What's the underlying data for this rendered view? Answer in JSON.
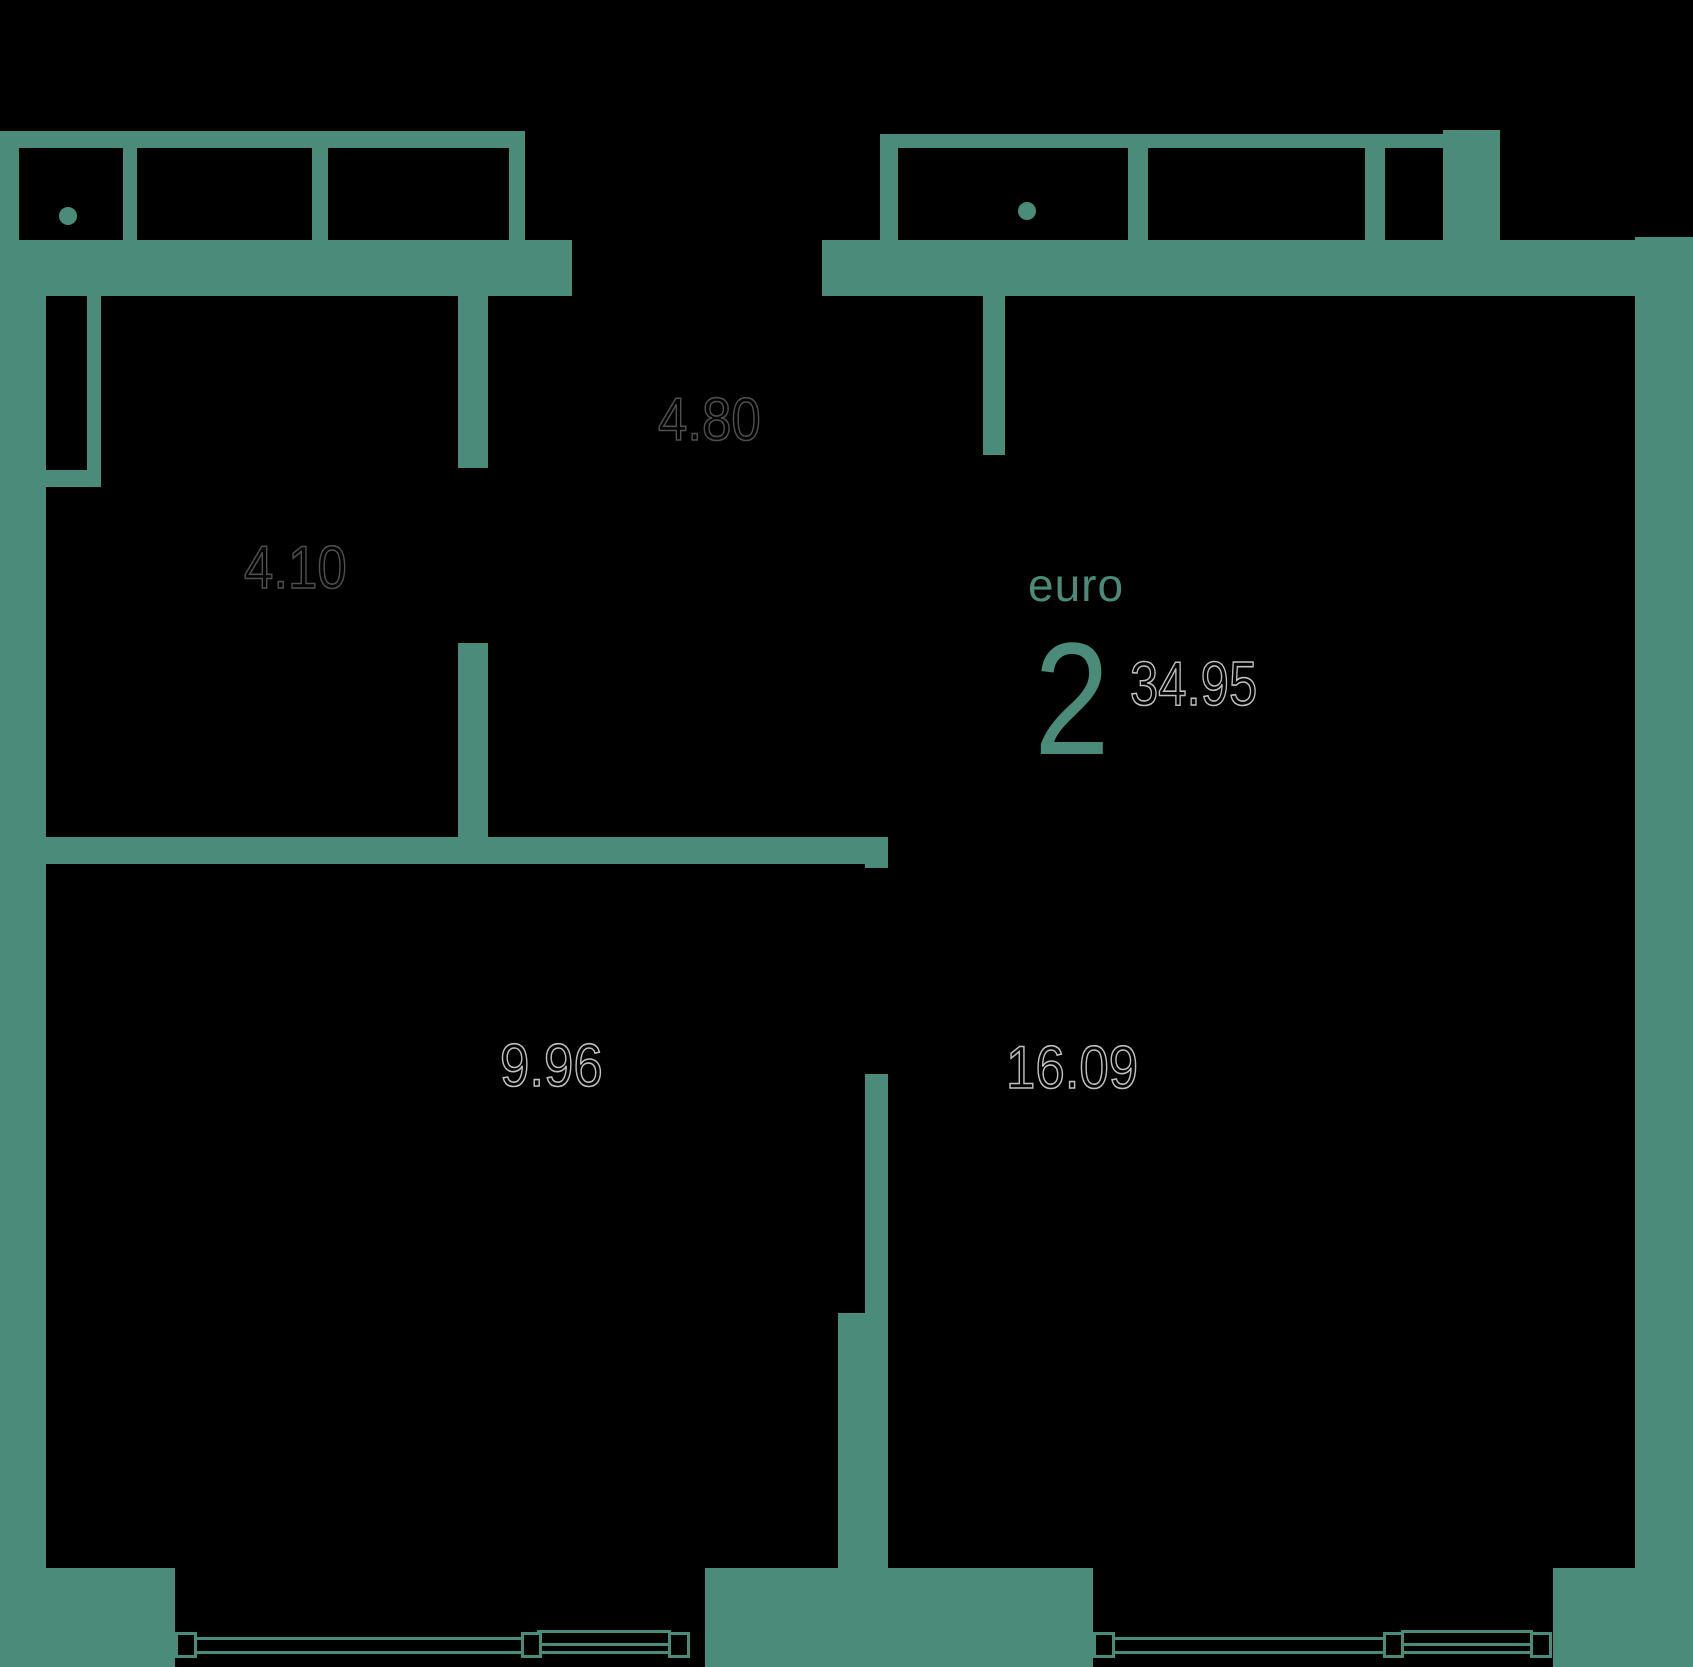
{
  "plan": {
    "unit_type_label": "euro",
    "rooms_count": "2",
    "total_area": "34.95",
    "rooms": [
      {
        "name": "hallway",
        "area": "4.80"
      },
      {
        "name": "bathroom",
        "area": "4.10"
      },
      {
        "name": "bedroom",
        "area": "9.96"
      },
      {
        "name": "living-kitchen",
        "area": "16.09"
      }
    ],
    "colors": {
      "wall": "#4a8b79",
      "background": "#000000",
      "label_outline_dim": "#4f4f4f",
      "label_outline_bright": "#c0c0c0"
    }
  }
}
